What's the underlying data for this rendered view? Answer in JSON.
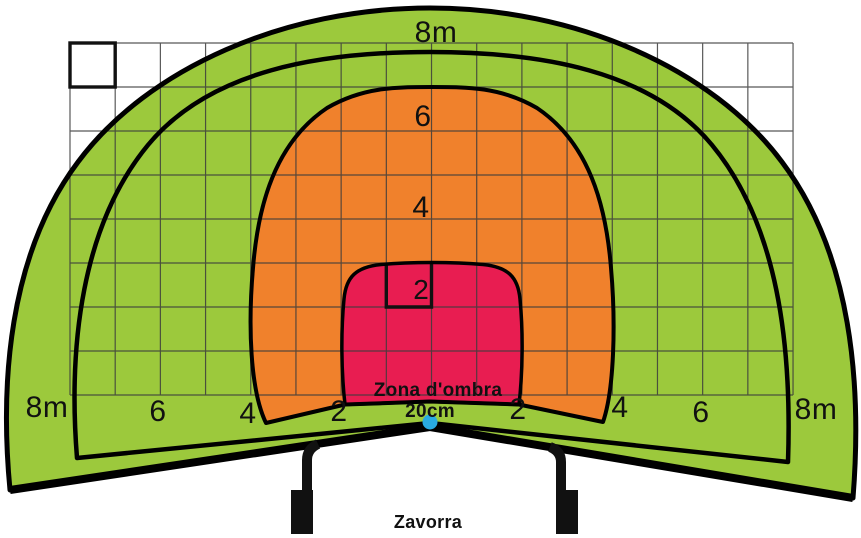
{
  "diagram": {
    "top_diameter_label": "8m",
    "rings": {
      "r6": "6",
      "r4": "4",
      "r2": "2"
    },
    "shadow_zone_label": "Zona d'ombra",
    "center_height_label": "20cm",
    "ballast_label": "Zavorra",
    "baseline_labels": [
      "8m",
      "6",
      "4",
      "2",
      "2",
      "4",
      "6",
      "8m"
    ],
    "colors": {
      "zone_outer_green": "#9cc93c",
      "zone_mid_orange": "#f0812c",
      "zone_inner_red": "#e81d51",
      "marker_dot_cyan": "#29abe2"
    }
  }
}
